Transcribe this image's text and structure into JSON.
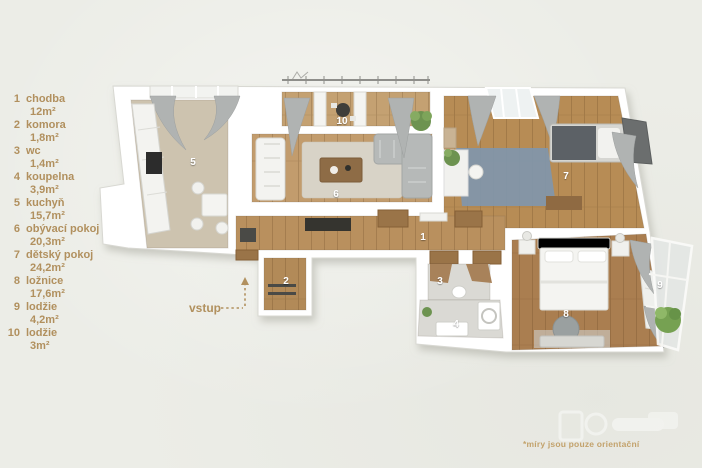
{
  "page": {
    "background": "#ecede7",
    "disclaimer": "*míry jsou pouze orientační"
  },
  "legend": {
    "text_color": "#b1905e",
    "items": [
      {
        "number": "1",
        "name": "chodba",
        "area": "12m²"
      },
      {
        "number": "2",
        "name": "komora",
        "area": "1,8m²"
      },
      {
        "number": "3",
        "name": "wc",
        "area": "1,4m²"
      },
      {
        "number": "4",
        "name": "koupelna",
        "area": "3,9m²"
      },
      {
        "number": "5",
        "name": "kuchyň",
        "area": "15,7m²"
      },
      {
        "number": "6",
        "name": "obývací pokoj",
        "area": "20,3m²"
      },
      {
        "number": "7",
        "name": "dětský pokoj",
        "area": "24,2m²"
      },
      {
        "number": "8",
        "name": "ložnice",
        "area": "17,6m²"
      },
      {
        "number": "9",
        "name": "lodžie",
        "area": "4,2m²"
      },
      {
        "number": "10",
        "name": "lodžie",
        "area": "3m²"
      }
    ]
  },
  "floorplan": {
    "entrance_label": "vstup",
    "labels": {
      "r1": "1",
      "r2": "2",
      "r3": "3",
      "r4": "4",
      "r5": "5",
      "r6": "6",
      "r7": "7",
      "r8": "8",
      "r9": "9",
      "r10": "10"
    },
    "colors": {
      "walls": "#ffffff",
      "wood_floor": "#b98e5d",
      "kitchen_carpet": "#cdc3af",
      "blue_rug": "#8296aa",
      "accent_text": "#b1905e",
      "curtains": "#b0b3b2"
    }
  }
}
